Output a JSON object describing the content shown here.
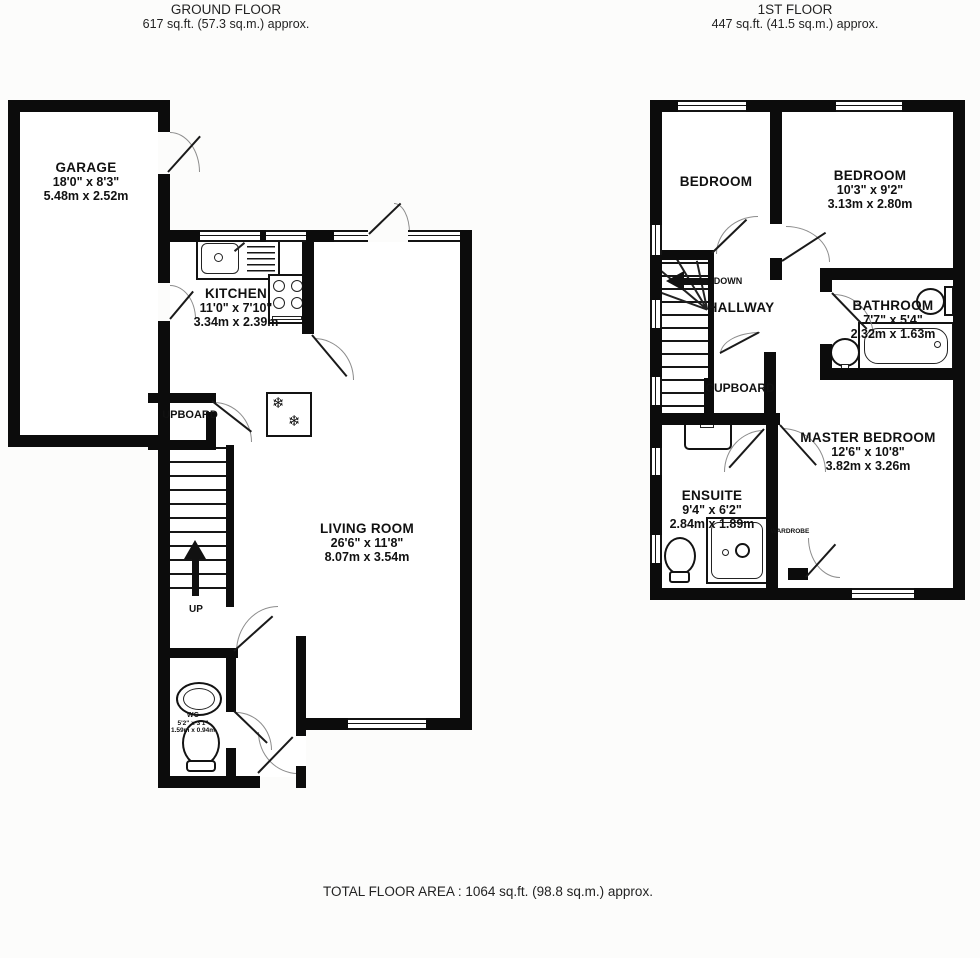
{
  "page": {
    "ground_header": {
      "title": "GROUND FLOOR",
      "area": "617 sq.ft. (57.3 sq.m.) approx."
    },
    "first_header": {
      "title": "1ST FLOOR",
      "area": "447 sq.ft. (41.5 sq.m.) approx."
    },
    "footer": "TOTAL FLOOR AREA : 1064 sq.ft. (98.8 sq.m.) approx."
  },
  "ground": {
    "rooms": {
      "garage": {
        "name": "GARAGE",
        "imperial": "18'0\" x 8'3\"",
        "metric": "5.48m x 2.52m"
      },
      "kitchen": {
        "name": "KITCHEN",
        "imperial": "11'0\" x 7'10\"",
        "metric": "3.34m x 2.39m"
      },
      "living": {
        "name": "LIVING ROOM",
        "imperial": "26'6\" x 11'8\"",
        "metric": "8.07m x 3.54m"
      },
      "wc": {
        "name": "WC",
        "imperial": "5'2\" x 3'1\"",
        "metric": "1.59m x 0.94m"
      },
      "cupboard": {
        "name": "UPBOARD"
      }
    },
    "stairs_label": "UP"
  },
  "first": {
    "rooms": {
      "bedroom_left": {
        "name": "BEDROOM"
      },
      "bedroom_right": {
        "name": "BEDROOM",
        "imperial": "10'3\" x 9'2\"",
        "metric": "3.13m x 2.80m"
      },
      "hallway": {
        "name": "HALLWAY"
      },
      "bathroom": {
        "name": "BATHROOM",
        "imperial": "7'7\" x 5'4\"",
        "metric": "2.32m x 1.63m"
      },
      "cupboard": {
        "name": "CUPBOARD"
      },
      "master": {
        "name": "MASTER BEDROOM",
        "imperial": "12'6\" x 10'8\"",
        "metric": "3.82m x 3.26m"
      },
      "ensuite": {
        "name": "ENSUITE",
        "imperial": "9'4\" x 6'2\"",
        "metric": "2.84m x 1.89m"
      },
      "wardrobe": {
        "name": "WARDROBE"
      }
    },
    "stairs_label": "DOWN"
  }
}
